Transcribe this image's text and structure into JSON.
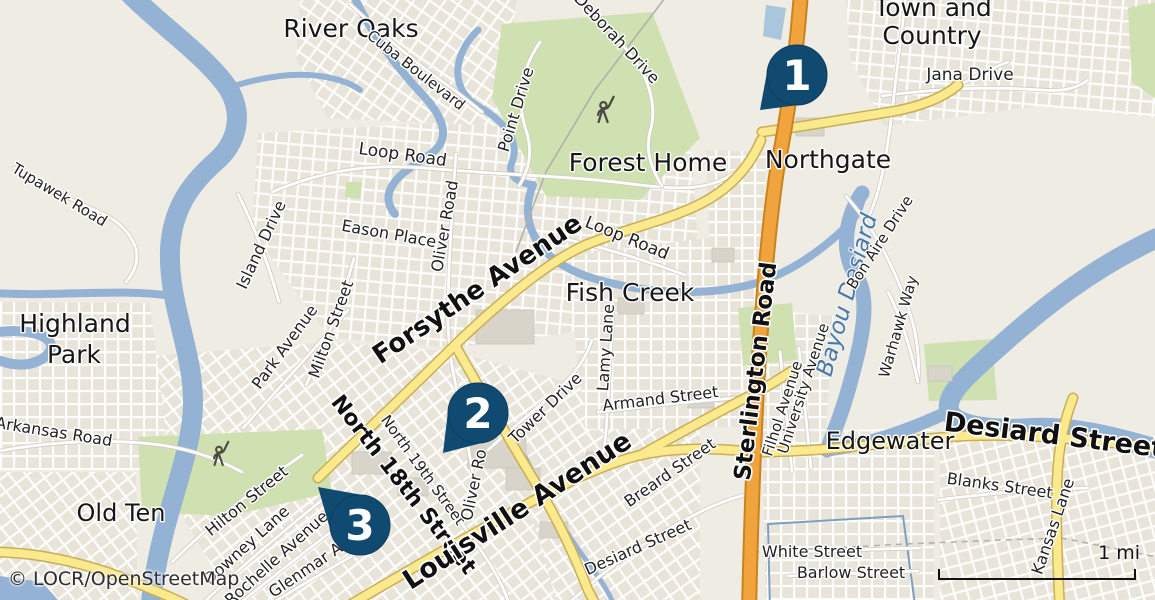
{
  "map": {
    "attribution": "© LOCR/OpenStreetMap",
    "scale_bar": {
      "label": "1 mi"
    },
    "markers": [
      {
        "n": "1",
        "cx": 797,
        "cy": 75,
        "tip": [
          -37,
          35
        ],
        "a": [
          -29.5,
          -5.5
        ],
        "b": [
          3.8,
          29.8
        ]
      },
      {
        "n": "2",
        "cx": 478,
        "cy": 413,
        "tip": [
          -35,
          40
        ],
        "a": [
          -29.8,
          -3.6
        ],
        "b": [
          7.5,
          29.0
        ]
      },
      {
        "n": "3",
        "cx": 360,
        "cy": 525,
        "tip": [
          -42,
          -38
        ],
        "a": [
          5.3,
          -29.5
        ],
        "b": [
          -28.8,
          8.2
        ]
      }
    ],
    "labels": [
      {
        "id": "river-oaks",
        "text": "River Oaks",
        "x": 351,
        "y": 37,
        "rot": 0,
        "size": 25,
        "kind": "place"
      },
      {
        "id": "town-and-country-1",
        "text": "Town and",
        "x": 933,
        "y": 16,
        "rot": 0,
        "size": 25,
        "kind": "place"
      },
      {
        "id": "town-and-country-2",
        "text": "Country",
        "x": 932,
        "y": 44,
        "rot": 0,
        "size": 25,
        "kind": "place"
      },
      {
        "id": "forest-home",
        "text": "Forest Home",
        "x": 648,
        "y": 171,
        "rot": 0,
        "size": 25,
        "kind": "place"
      },
      {
        "id": "northgate",
        "text": "Northgate",
        "x": 828,
        "y": 168,
        "rot": 0,
        "size": 25,
        "kind": "place"
      },
      {
        "id": "fish-creek",
        "text": "Fish Creek",
        "x": 630,
        "y": 301,
        "rot": 0,
        "size": 25,
        "kind": "place"
      },
      {
        "id": "highland-park-1",
        "text": "Highland",
        "x": 75,
        "y": 332,
        "rot": 0,
        "size": 25,
        "kind": "place"
      },
      {
        "id": "highland-park-2",
        "text": "Park",
        "x": 74,
        "y": 363,
        "rot": 0,
        "size": 25,
        "kind": "place"
      },
      {
        "id": "edgewater",
        "text": "Edgewater",
        "x": 890,
        "y": 449,
        "rot": 0,
        "size": 24,
        "kind": "place"
      },
      {
        "id": "old-ten",
        "text": "Old Ten",
        "x": 121,
        "y": 521,
        "rot": 0,
        "size": 24,
        "kind": "place"
      },
      {
        "id": "sterlington-road",
        "text": "Sterlington Road",
        "x": 763,
        "y": 372,
        "rot": -83,
        "size": 23,
        "kind": "road",
        "weight": 700
      },
      {
        "id": "north-18th-street",
        "text": "North 18th Street",
        "x": 398,
        "y": 489,
        "rot": 52,
        "size": 22,
        "kind": "road",
        "weight": 700
      },
      {
        "id": "louisville-avenue",
        "text": "Louisville Avenue",
        "x": 522,
        "y": 518,
        "rot": -33,
        "size": 27,
        "kind": "road",
        "weight": 700
      },
      {
        "id": "desiard-street",
        "text": "Desiard Street",
        "x": 1053,
        "y": 444,
        "rot": 7,
        "size": 27,
        "kind": "road",
        "weight": 700
      },
      {
        "id": "forsythe-avenue",
        "text": "Forsythe Avenue",
        "x": 482,
        "y": 296,
        "rot": -34,
        "size": 26,
        "kind": "road",
        "weight": 600
      },
      {
        "id": "bayou-desiard",
        "text": "Bayou Desiard",
        "x": 854,
        "y": 297,
        "rot": -74,
        "size": 23,
        "kind": "water"
      },
      {
        "id": "jana-drive",
        "text": "Jana Drive",
        "x": 970,
        "y": 80,
        "rot": 0,
        "size": 17,
        "kind": "street"
      },
      {
        "id": "deborah-drive",
        "text": "Deborah Drive",
        "x": 613,
        "y": 42,
        "rot": 47,
        "size": 16,
        "kind": "street"
      },
      {
        "id": "cuba-boulevard",
        "text": "Cuba Boulevard",
        "x": 413,
        "y": 74,
        "rot": 38,
        "size": 15,
        "kind": "street"
      },
      {
        "id": "point-drive",
        "text": "Point Drive",
        "x": 521,
        "y": 111,
        "rot": -73,
        "size": 16,
        "kind": "street"
      },
      {
        "id": "loop-road-n",
        "text": "Loop Road",
        "x": 402,
        "y": 160,
        "rot": 8,
        "size": 17,
        "kind": "street"
      },
      {
        "id": "loop-road-e",
        "text": "Loop Road",
        "x": 625,
        "y": 243,
        "rot": 22,
        "size": 17,
        "kind": "street"
      },
      {
        "id": "eason-place",
        "text": "Eason Place",
        "x": 388,
        "y": 239,
        "rot": 10,
        "size": 16,
        "kind": "street"
      },
      {
        "id": "oliver-road",
        "text": "Oliver Road",
        "x": 450,
        "y": 227,
        "rot": -80,
        "size": 16,
        "kind": "street"
      },
      {
        "id": "island-drive",
        "text": "Island Drive",
        "x": 266,
        "y": 247,
        "rot": -65,
        "size": 16,
        "kind": "street"
      },
      {
        "id": "park-avenue",
        "text": "Park Avenue",
        "x": 289,
        "y": 350,
        "rot": -54,
        "size": 16,
        "kind": "street"
      },
      {
        "id": "milton-street",
        "text": "Milton Street",
        "x": 336,
        "y": 331,
        "rot": -70,
        "size": 16,
        "kind": "street"
      },
      {
        "id": "tupawek-road",
        "text": "Tupawek Road",
        "x": 57,
        "y": 199,
        "rot": 31,
        "size": 15,
        "kind": "street"
      },
      {
        "id": "arkansas-road",
        "text": "Arkansas Road",
        "x": 53,
        "y": 437,
        "rot": 9,
        "size": 16,
        "kind": "street"
      },
      {
        "id": "bon-aire-drive",
        "text": "Bon Aire Drive",
        "x": 884,
        "y": 245,
        "rot": -57,
        "size": 15,
        "kind": "street"
      },
      {
        "id": "warhawk-way",
        "text": "Warhawk Way",
        "x": 903,
        "y": 328,
        "rot": -74,
        "size": 15,
        "kind": "street"
      },
      {
        "id": "filhol-avenue",
        "text": "Filhol Avenue",
        "x": 787,
        "y": 410,
        "rot": -72,
        "size": 15,
        "kind": "street"
      },
      {
        "id": "university-avenue",
        "text": "University Avenue",
        "x": 808,
        "y": 390,
        "rot": -72,
        "size": 15,
        "kind": "street"
      },
      {
        "id": "lamy-lane",
        "text": "Lamy Lane",
        "x": 611,
        "y": 348,
        "rot": -86,
        "size": 16,
        "kind": "street"
      },
      {
        "id": "armand-street",
        "text": "Armand Street",
        "x": 661,
        "y": 404,
        "rot": -7,
        "size": 16,
        "kind": "street"
      },
      {
        "id": "tower-drive",
        "text": "Tower Drive",
        "x": 549,
        "y": 412,
        "rot": -44,
        "size": 16,
        "kind": "street"
      },
      {
        "id": "north-19th-street",
        "text": "North 19th Street",
        "x": 419,
        "y": 473,
        "rot": 54,
        "size": 15,
        "kind": "street"
      },
      {
        "id": "oliver-road-s",
        "text": "Oliver Ro",
        "x": 479,
        "y": 486,
        "rot": -78,
        "size": 16,
        "kind": "street"
      },
      {
        "id": "breard-street",
        "text": "Breard Street",
        "x": 673,
        "y": 477,
        "rot": -35,
        "size": 16,
        "kind": "street"
      },
      {
        "id": "desiard-street-s",
        "text": "Desiard Street",
        "x": 640,
        "y": 552,
        "rot": -24,
        "size": 16,
        "kind": "street"
      },
      {
        "id": "hilton-street",
        "text": "Hilton Street",
        "x": 250,
        "y": 505,
        "rot": -39,
        "size": 16,
        "kind": "street"
      },
      {
        "id": "downey-lane",
        "text": "Downey Lane",
        "x": 250,
        "y": 549,
        "rot": -42,
        "size": 16,
        "kind": "street"
      },
      {
        "id": "rochelle-avenue",
        "text": "Rochelle Avenue",
        "x": 280,
        "y": 562,
        "rot": -42,
        "size": 16,
        "kind": "street"
      },
      {
        "id": "glenmar-avenue",
        "text": "Glenmar Av",
        "x": 312,
        "y": 572,
        "rot": -34,
        "size": 16,
        "kind": "street"
      },
      {
        "id": "blanks-street",
        "text": "Blanks Street",
        "x": 999,
        "y": 491,
        "rot": 8,
        "size": 16,
        "kind": "street"
      },
      {
        "id": "kansas-lane",
        "text": "Kansas Lane",
        "x": 1058,
        "y": 528,
        "rot": -71,
        "size": 16,
        "kind": "street"
      },
      {
        "id": "white-street",
        "text": "White Street",
        "x": 812,
        "y": 557,
        "rot": 0,
        "size": 16,
        "kind": "street"
      },
      {
        "id": "barlow-street",
        "text": "Barlow Street",
        "x": 851,
        "y": 578,
        "rot": 0,
        "size": 16,
        "kind": "street"
      }
    ]
  },
  "colors": {
    "land": "#efece3",
    "water": "#94b2d4",
    "park": "#cfe1b0",
    "road_yellow": "#fbe98d",
    "road_orange": "#f1a43e",
    "marker": "#114a70",
    "marker_edge": "#0b3c5e",
    "water_label": "#4a78a2",
    "boundary": "#7d9ec2"
  }
}
